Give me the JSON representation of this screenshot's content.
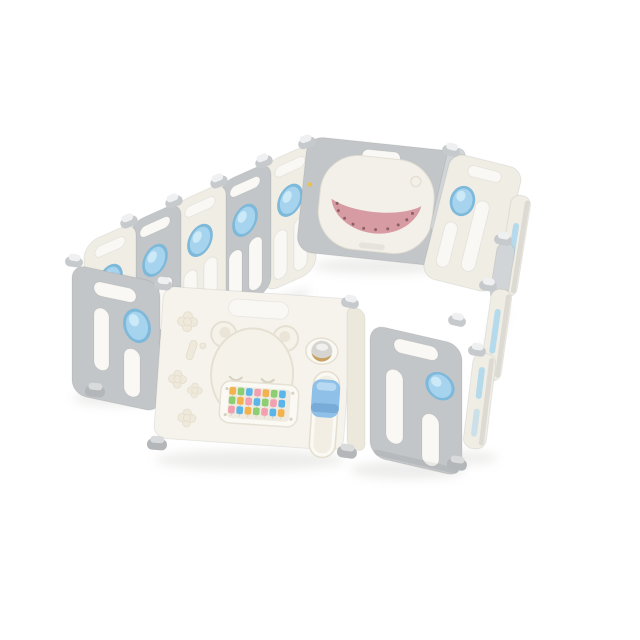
{
  "image": {
    "type": "product-photo",
    "subject": "Foldable baby playpen fence, isometric view on white background",
    "background": "white"
  },
  "colors": {
    "cream": "#f0ede5",
    "cream-bright": "#f6f3ed",
    "gray": "#c3c6c8",
    "gray-light": "#d2d5d7",
    "slot": "#f9f8f4",
    "blue": "#a6d4ee",
    "blue-rim": "#7fb9da",
    "blue-light": "#d2ecf8",
    "pink": "#d79ba3",
    "pink-dark": "#b97f88",
    "dot": "#8f5f66",
    "tan": "#c9a261",
    "latch-blue": "#8ec0e8",
    "latch-blue-dark": "#74a7d3",
    "emboss": "#e6e0d3",
    "shadow": "#c9c9c6",
    "yellow-dot": "#e8c24a"
  },
  "playpen": {
    "back_left_panels": [
      {
        "color": "cream",
        "lock": "blue-oval"
      },
      {
        "color": "gray",
        "lock": "blue-oval"
      },
      {
        "color": "cream",
        "lock": "blue-oval"
      },
      {
        "color": "gray",
        "lock": "blue-oval"
      },
      {
        "color": "cream",
        "lock": "blue-oval"
      }
    ],
    "back_center_panel": {
      "color": "gray",
      "feature": "whale play panel",
      "mouth": "pink tray with dotted smile",
      "eye": "embossed circle"
    },
    "right_side_panels": {
      "appearance": "seen edge-on",
      "accents": "blue lock slivers",
      "count": 4
    },
    "front_panels": [
      {
        "position": "left-corner",
        "color": "gray",
        "lock": "blue-oval"
      },
      {
        "position": "center",
        "color": "cream",
        "role": "door"
      },
      {
        "position": "right",
        "color": "gray",
        "lock": "blue-oval"
      }
    ],
    "hinges": "white-gray twin knobs at panel joints"
  },
  "door_panel": {
    "embosses": [
      "bear face",
      "clover flowers",
      "capsule"
    ],
    "handle_slot": true,
    "knob": {
      "style": "rotary child-lock dial",
      "accent_key": "tan"
    },
    "latch": {
      "style": "sliding lock handle",
      "color_key": "latch-blue"
    },
    "abacus": {
      "rows": 3,
      "columns": 7,
      "bead_rows": [
        [
          "#f2b24c",
          "#8ccf72",
          "#5ab5e8",
          "#f2a0b0",
          "#f2b24c",
          "#8ccf72",
          "#5ab5e8"
        ],
        [
          "#8ccf72",
          "#f2b24c",
          "#f2a0b0",
          "#5ab5e8",
          "#8ccf72",
          "#f2a0b0",
          "#5ab5e8"
        ],
        [
          "#f2a0b0",
          "#5ab5e8",
          "#f2b24c",
          "#8ccf72",
          "#f2a0b0",
          "#5ab5e8",
          "#f2b24c"
        ]
      ]
    }
  }
}
